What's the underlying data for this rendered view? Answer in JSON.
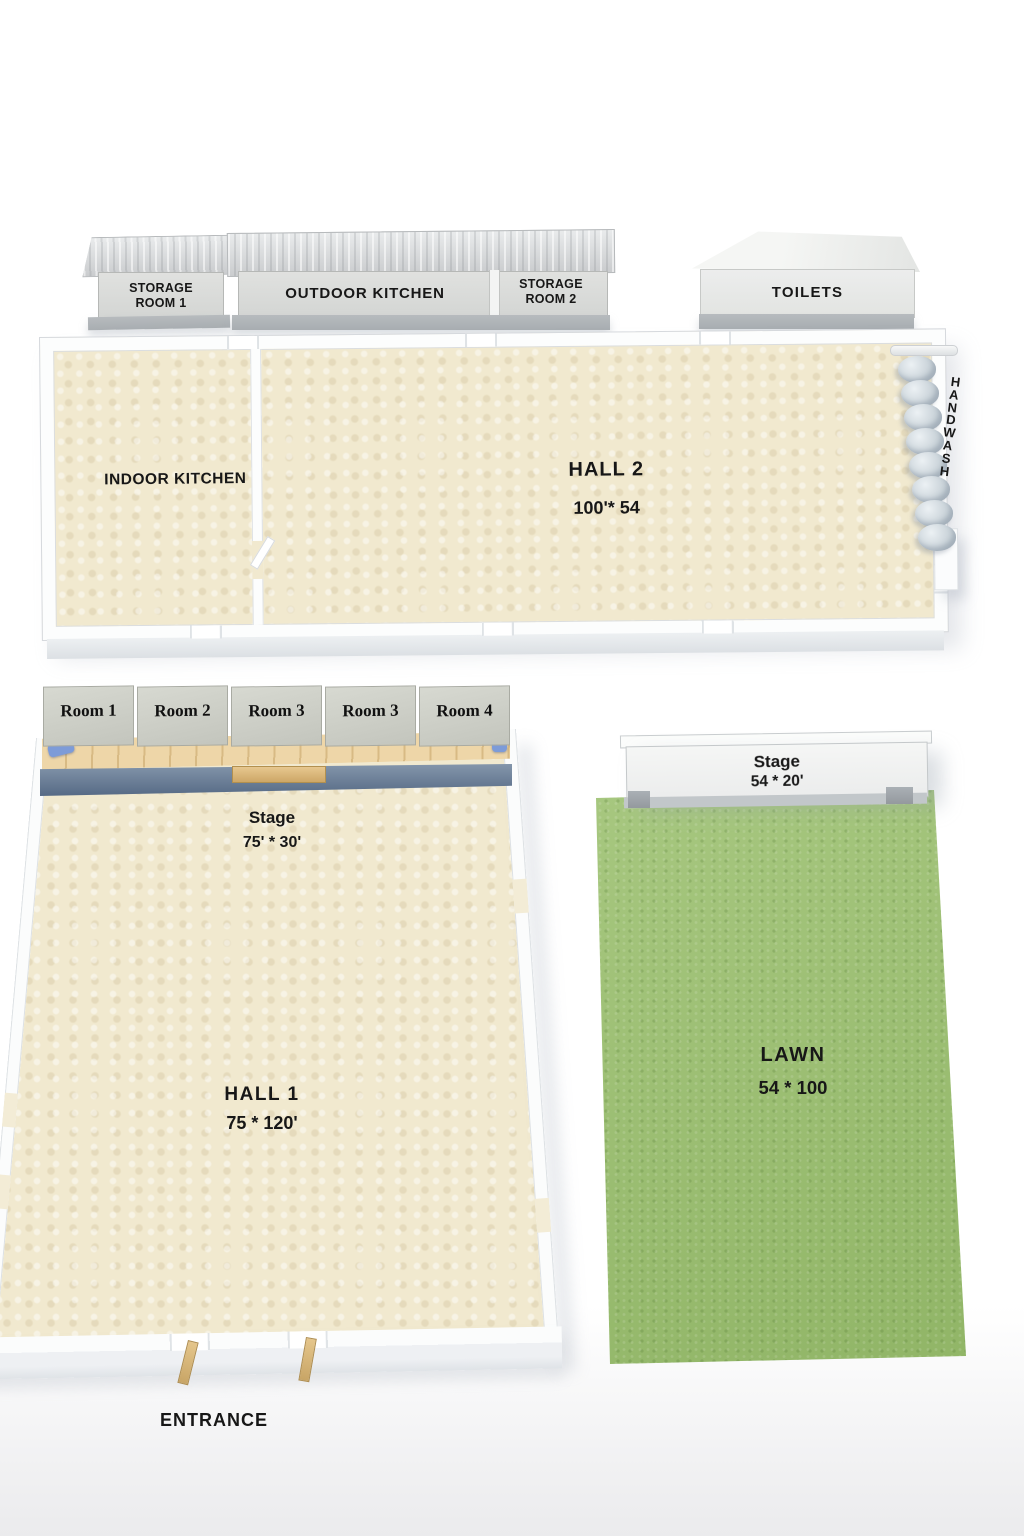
{
  "title": "Event venue floor plan",
  "top_row": {
    "storage_room_1": "STORAGE\nROOM 1",
    "outdoor_kitchen": "OUTDOOR KITCHEN",
    "storage_room_2": "STORAGE\nROOM 2",
    "toilets": "TOILETS"
  },
  "main_building": {
    "indoor_kitchen": "INDOOR KITCHEN",
    "hall_2": {
      "name": "HALL 2",
      "size": "100'* 54"
    },
    "hand_wash_vertical": "H\nA\nN\nD\nW\nA\nS\nH"
  },
  "hall_1": {
    "rooms": [
      {
        "label": "Room 1"
      },
      {
        "label": "Room 2"
      },
      {
        "label": "Room 3"
      },
      {
        "label": "Room 3"
      },
      {
        "label": "Room 4"
      }
    ],
    "stage": {
      "name": "Stage",
      "size": "75' * 30'"
    },
    "name": "HALL 1",
    "size": "75 * 120'",
    "entrance": "ENTRANCE"
  },
  "outdoor": {
    "stage": {
      "name": "Stage",
      "size": "54 * 20'"
    },
    "lawn": {
      "name": "LAWN",
      "size": "54 * 100"
    }
  },
  "colors": {
    "floor_tile": "#f1e9cf",
    "lawn_green": "#9dc171",
    "wall_white": "#fcfdfd",
    "roof_gray": "#d7d9db",
    "stage_wood": "#e9cf9e",
    "stage_skirt": "#63778f",
    "stair_blue": "#7d9bd8",
    "label_text": "#171717"
  }
}
